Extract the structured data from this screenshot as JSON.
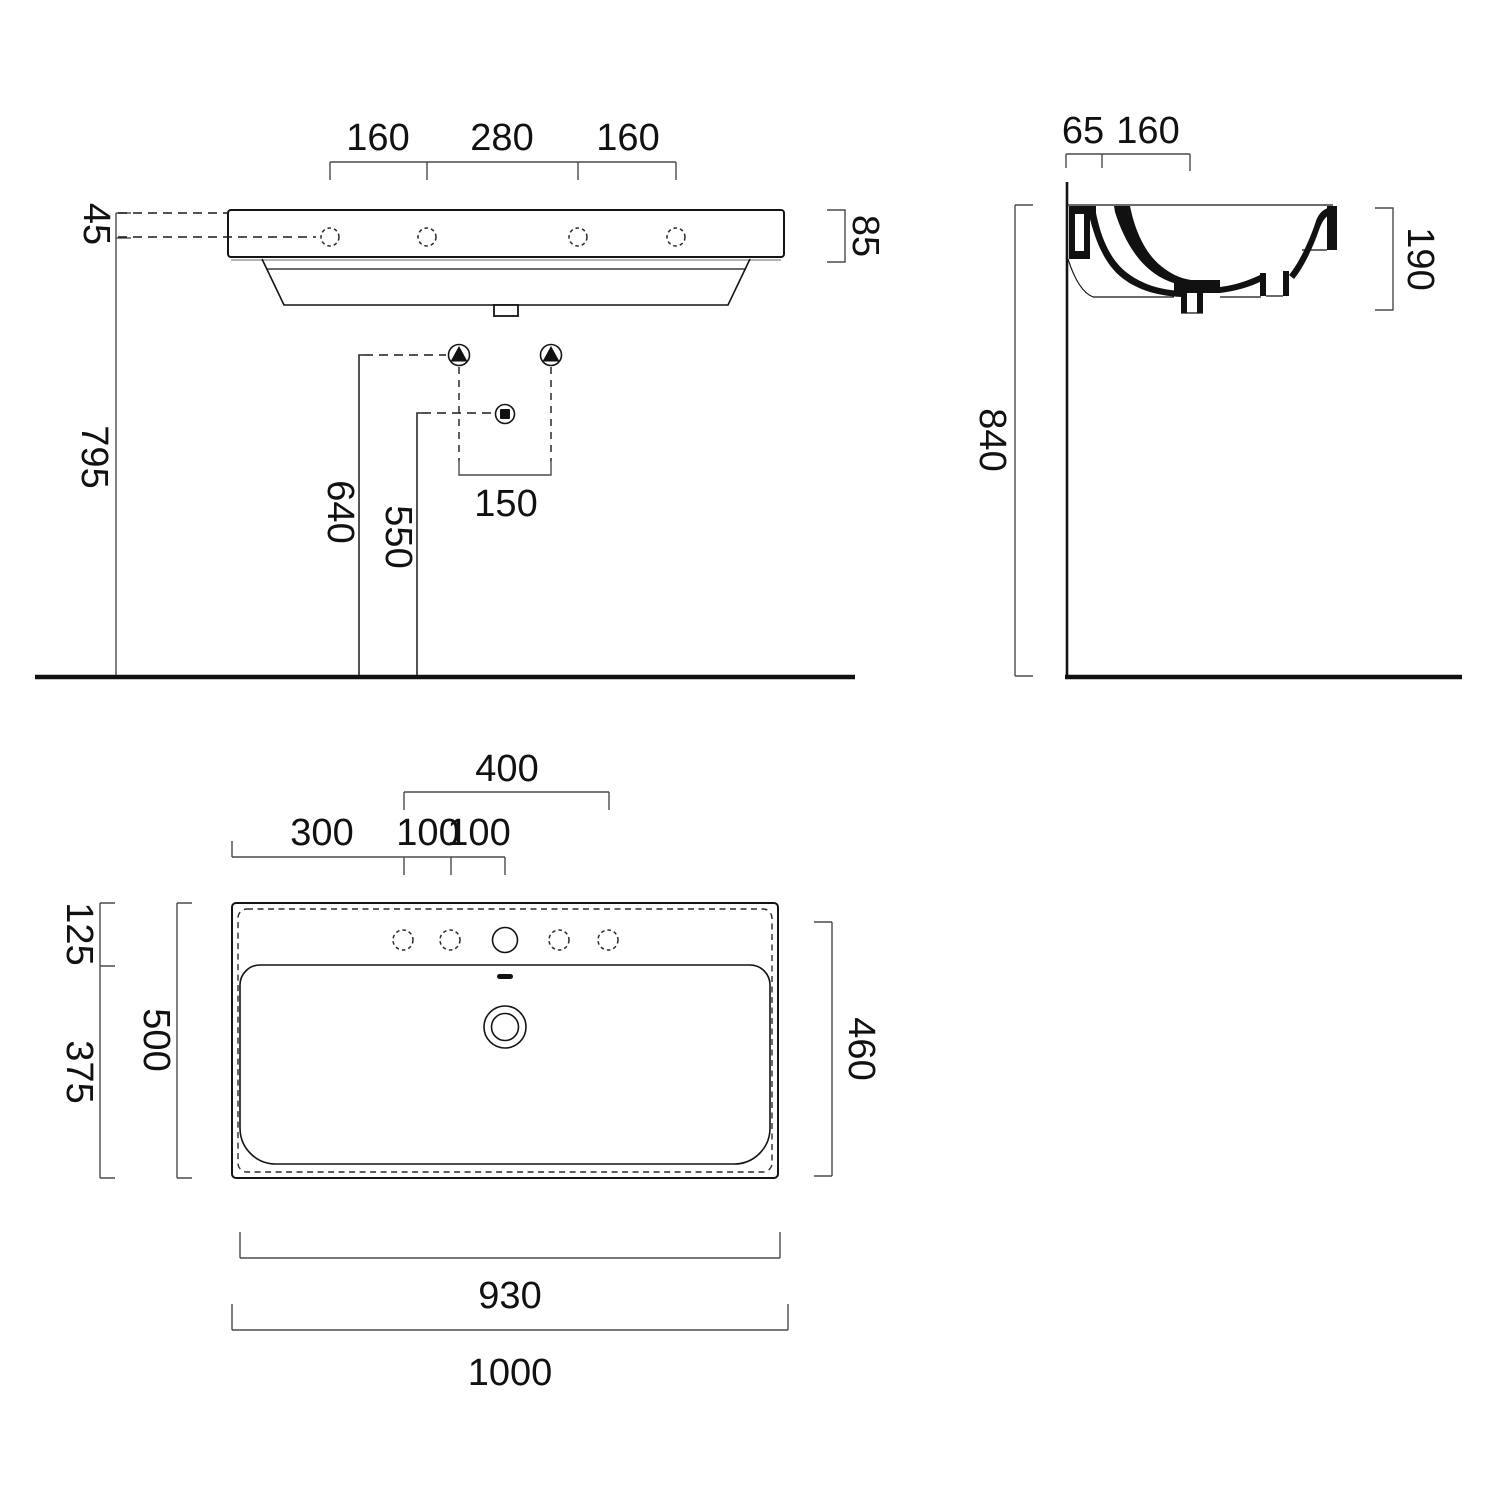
{
  "drawing": {
    "type": "washbasin-technical-dimension-drawing",
    "units": "mm",
    "line_color": "#141414",
    "background": "#ffffff"
  },
  "symbols": {
    "water_supply": "triangle-up-in-circle",
    "waste_outlet": "square-in-circle"
  },
  "front_view": {
    "top_dims": [
      "160",
      "280",
      "160"
    ],
    "rim_height": "85",
    "hole_offset_from_top": "45",
    "hole_height_from_floor": "795",
    "supply_height": "640",
    "drain_height": "550",
    "supply_spacing": "150"
  },
  "side_view": {
    "wall_to_hole": "65",
    "hole_to_drain": "160",
    "basin_section_height": "190",
    "rim_height_from_floor": "840"
  },
  "plan_view": {
    "outer_hole_span": "400",
    "edge_to_first_hole": "300",
    "hole_gap_1": "100",
    "hole_gap_2": "100",
    "back_ledge_depth": "125",
    "bowl_depth": "375",
    "total_depth": "500",
    "front_depth": "460",
    "inner_width": "930",
    "total_width": "1000"
  }
}
